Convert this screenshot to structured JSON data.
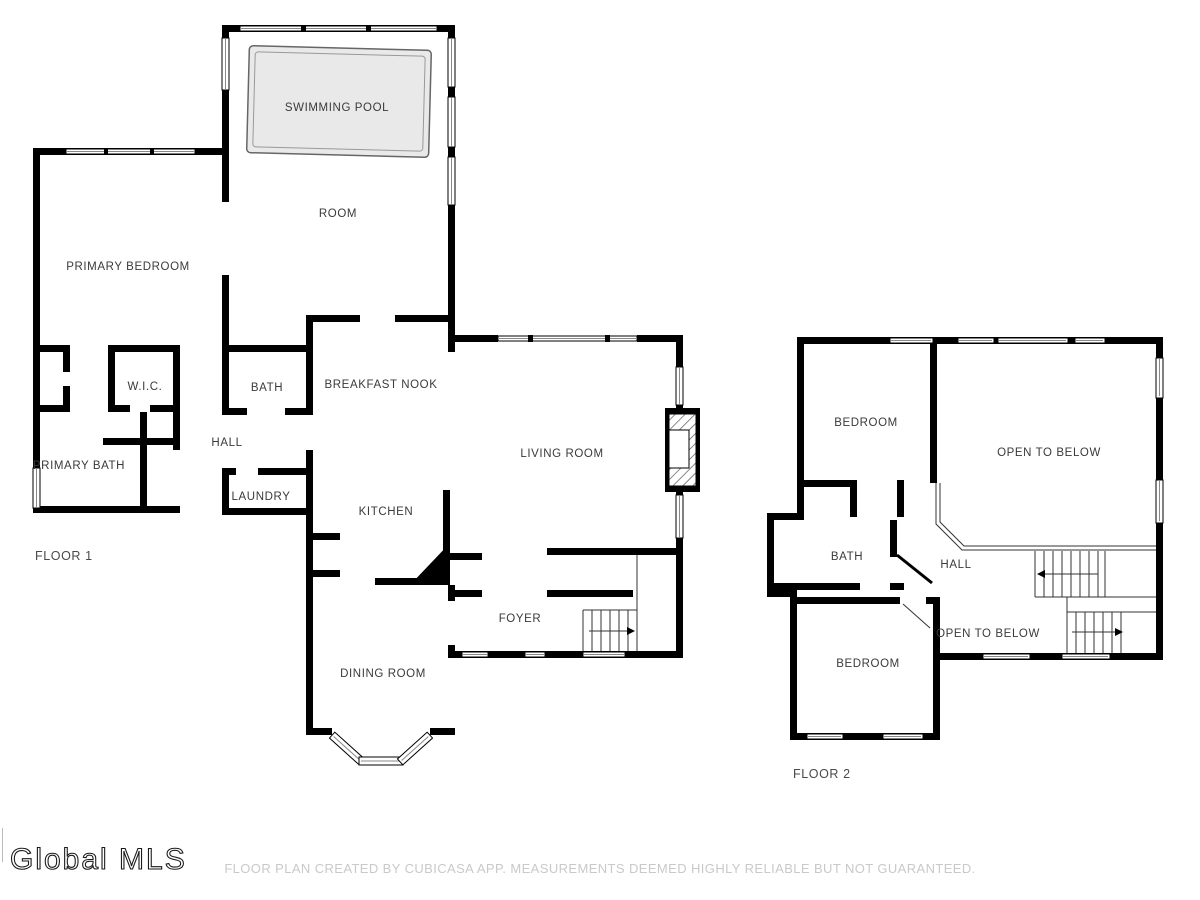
{
  "page": {
    "background": "#ffffff",
    "wall_color": "#000000",
    "pool_fill": "#e9e9e9",
    "label_color": "#3a3a3a",
    "footer_color": "#c9c9c9"
  },
  "branding": {
    "logo_text": "Global MLS"
  },
  "footer": {
    "disclaimer": "FLOOR PLAN CREATED BY CUBICASA APP. MEASUREMENTS DEEMED HIGHLY RELIABLE BUT NOT GUARANTEED."
  },
  "floor1": {
    "title": "FLOOR 1",
    "rooms": [
      {
        "label": "SWIMMING POOL"
      },
      {
        "label": "ROOM"
      },
      {
        "label": "PRIMARY BEDROOM"
      },
      {
        "label": "W.I.C."
      },
      {
        "label": "BATH"
      },
      {
        "label": "BREAKFAST NOOK"
      },
      {
        "label": "HALL"
      },
      {
        "label": "PRIMARY BATH"
      },
      {
        "label": "LAUNDRY"
      },
      {
        "label": "KITCHEN"
      },
      {
        "label": "LIVING ROOM"
      },
      {
        "label": "FOYER"
      },
      {
        "label": "DINING ROOM"
      }
    ]
  },
  "floor2": {
    "title": "FLOOR 2",
    "rooms": [
      {
        "label": "BEDROOM"
      },
      {
        "label": "OPEN TO BELOW"
      },
      {
        "label": "BATH"
      },
      {
        "label": "HALL"
      },
      {
        "label": "BEDROOM"
      },
      {
        "label": "OPEN TO BELOW"
      }
    ]
  }
}
